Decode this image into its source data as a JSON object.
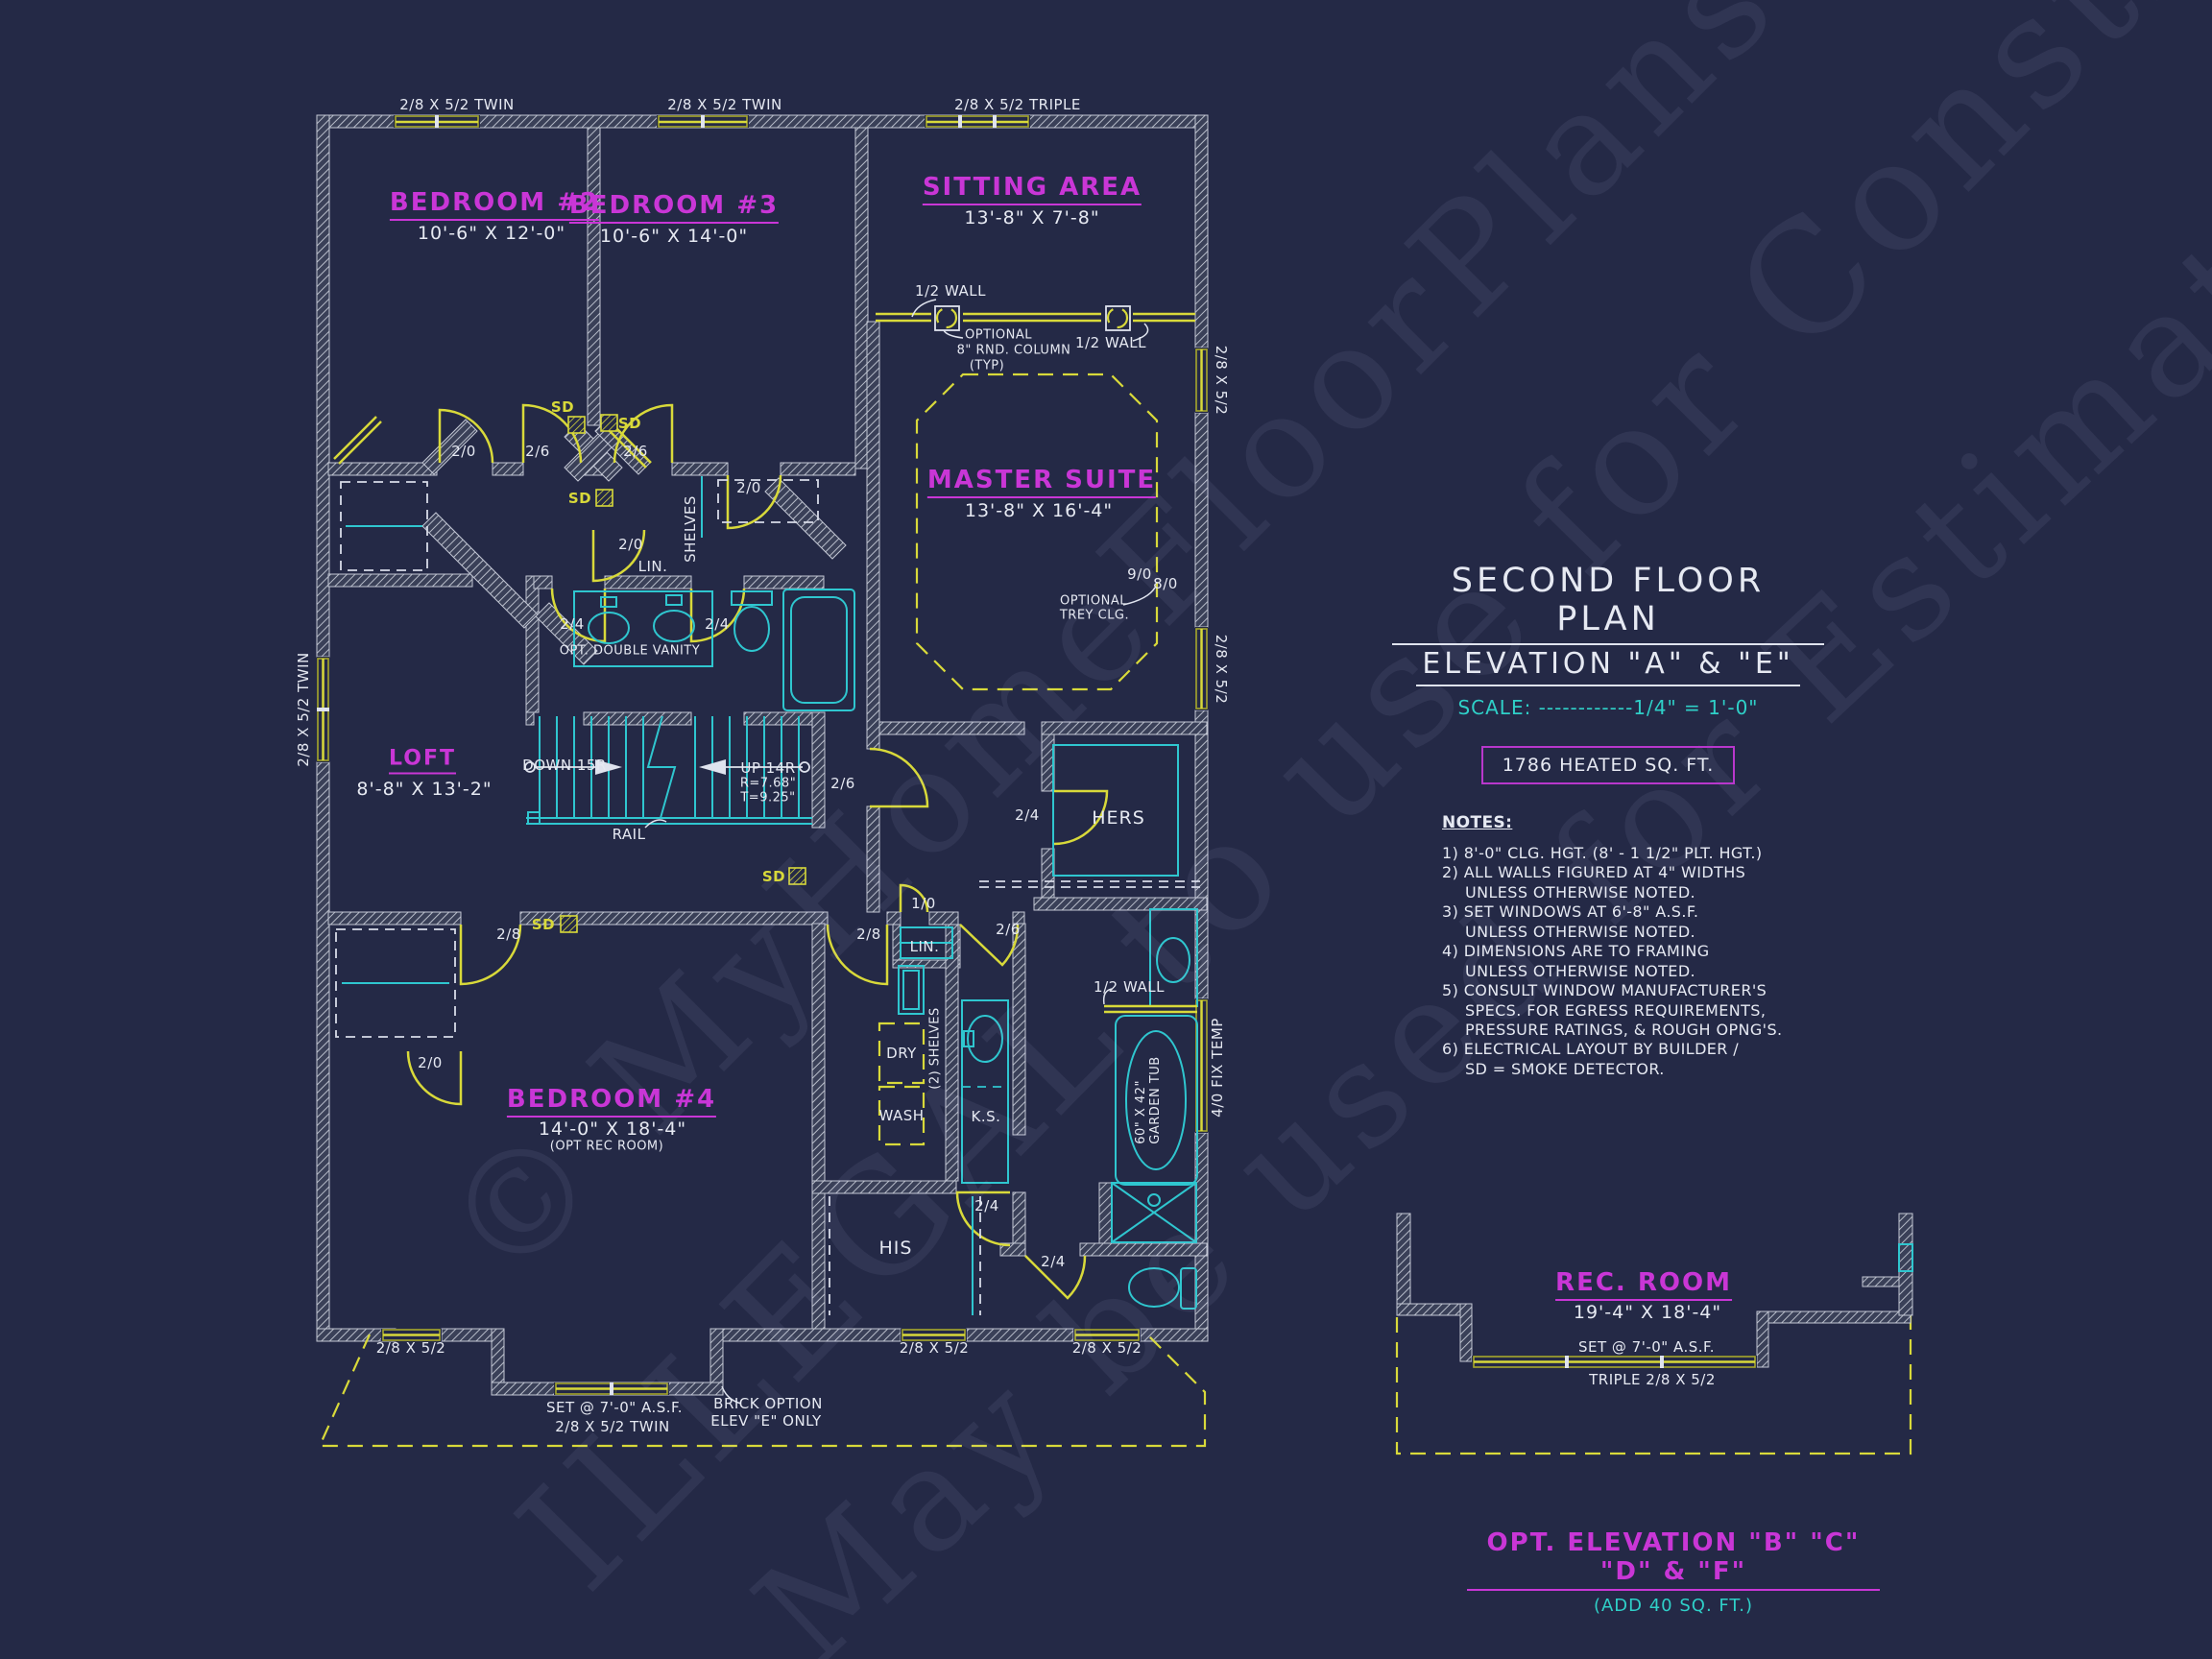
{
  "meta": {
    "background": "#242946",
    "cyan": "#2fc6cf",
    "yellow": "#d8d93a",
    "magenta": "#c936d6",
    "white": "#e6e9f2",
    "teal": "#2fd0c8"
  },
  "plan": {
    "rooms": {
      "bedroom2": {
        "name": "BEDROOM #2",
        "dims": "10'-6\" X 12'-0\""
      },
      "bedroom3": {
        "name": "BEDROOM #3",
        "dims": "10'-6\" X 14'-0\""
      },
      "sitting": {
        "name": "SITTING AREA",
        "dims": "13'-8\" X 7'-8\""
      },
      "master": {
        "name": "MASTER SUITE",
        "dims": "13'-8\" X 16'-4\""
      },
      "loft": {
        "name": "LOFT",
        "dims": "8'-8\" X 13'-2\""
      },
      "bedroom4": {
        "name": "BEDROOM #4",
        "dims": "14'-0\" X 18'-4\"",
        "sub": "(OPT REC ROOM)"
      },
      "rec_room": {
        "name": "REC. ROOM",
        "dims": "19'-4\" X 18'-4\""
      }
    },
    "windows": {
      "twin": "2/8 X 5/2 TWIN",
      "triple": "2/8 X 5/2 TRIPLE",
      "single": "2/8 X 5/2",
      "fix": "4/0 FIX TEMP",
      "rec_triple": "TRIPLE 2/8 X 5/2",
      "set_asf": "SET @ 7'-0\" A.S.F."
    },
    "doors": {
      "d20": "2/0",
      "d24": "2/4",
      "d26": "2/6",
      "d28": "2/8",
      "d10": "1/0"
    },
    "closets": {
      "hers": "HERS",
      "his": "HIS",
      "lin": "LIN.",
      "shelves": "SHELVES",
      "shelves2": "(2) SHELVES"
    },
    "fixtures": {
      "vanity": "OPT. DOUBLE VANITY",
      "tub_size": "60\" X 42\"",
      "tub_name": "GARDEN TUB",
      "ks": "K.S.",
      "wash": "WASH",
      "dry": "DRY",
      "rail": "RAIL",
      "down": "DOWN 15R",
      "up": "UP 14R",
      "rise": "R=7.68\"",
      "tread": "T=9.25\""
    },
    "annotations": {
      "half_wall": "1/2 WALL",
      "opt_col1": "OPTIONAL",
      "opt_col2": "8\" RND. COLUMN",
      "opt_col3": "(TYP)",
      "trey1": "OPTIONAL",
      "trey2": "TREY CLG.",
      "c90": "9/0",
      "c80": "8/0",
      "brick1": "BRICK OPTION",
      "brick2": "ELEV \"E\" ONLY",
      "sd": "SD"
    }
  },
  "title_block": {
    "line1": "SECOND FLOOR PLAN",
    "line2": "ELEVATION \"A\" & \"E\"",
    "scale": "SCALE: ------------1/4\" = 1'-0\"",
    "heated": "1786 HEATED SQ. FT.",
    "notes_title": "NOTES:",
    "notes": [
      "1) 8'-0\"  CLG. HGT. (8' - 1 1/2\" PLT. HGT.)",
      "2) ALL  WALLS FIGURED AT 4\" WIDTHS",
      "UNLESS OTHERWISE NOTED.",
      "3) SET WINDOWS AT 6'-8\" A.S.F.",
      "UNLESS OTHERWISE NOTED.",
      "4) DIMENSIONS ARE TO FRAMING",
      "UNLESS OTHERWISE NOTED.",
      "5) CONSULT WINDOW MANUFACTURER'S",
      "SPECS. FOR EGRESS REQUIREMENTS,",
      "PRESSURE RATINGS, & ROUGH OPNG'S.",
      "6) ELECTRICAL LAYOUT BY BUILDER /",
      "SD = SMOKE DETECTOR."
    ]
  },
  "footer": {
    "opt_elevation": "OPT. ELEVATION \"B\" \"C\" \"D\" & \"F\"",
    "add_sqft": "(ADD 40 SQ. FT.)"
  },
  "watermark": {
    "line1": "© MyHomeFloorPlans.com",
    "line2": "ILLEGAL to use for Construction",
    "line3": "May be used for Estimations"
  }
}
